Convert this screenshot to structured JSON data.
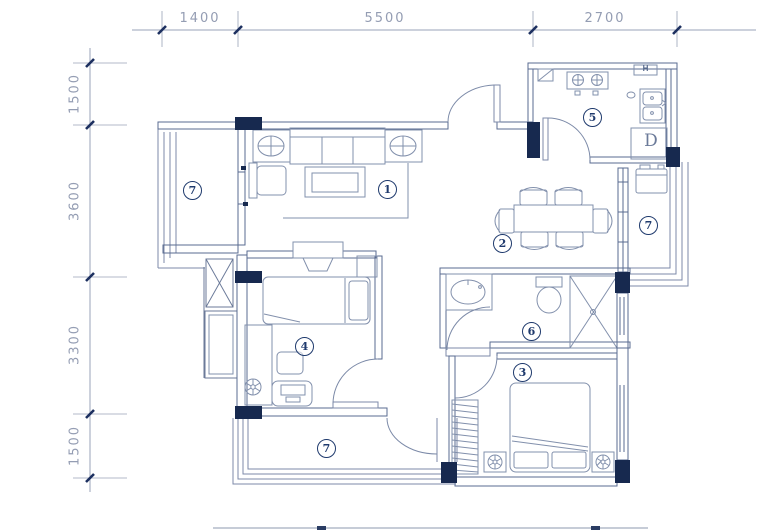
{
  "title": "apartment-floor-plan",
  "colors": {
    "wall_line": "#5a6b90",
    "furniture_line": "#8290ac",
    "column_fill": "#17294f",
    "dimension_text": "#949db3",
    "label_color": "#1f3a6d"
  },
  "dimensions": {
    "top": [
      {
        "text": "1400"
      },
      {
        "text": "5500"
      },
      {
        "text": "2700"
      }
    ],
    "left": [
      {
        "text": "1500"
      },
      {
        "text": "3600"
      },
      {
        "text": "3300"
      },
      {
        "text": "1500"
      }
    ]
  },
  "rooms": [
    {
      "num": "1",
      "name": "living-room"
    },
    {
      "num": "2",
      "name": "dining-room"
    },
    {
      "num": "3",
      "name": "bedroom-secondary"
    },
    {
      "num": "4",
      "name": "bedroom-master"
    },
    {
      "num": "5",
      "name": "kitchen"
    },
    {
      "num": "6",
      "name": "bathroom"
    },
    {
      "num": "7",
      "name": "balcony-left"
    },
    {
      "num": "7",
      "name": "balcony-right"
    },
    {
      "num": "7",
      "name": "balcony-bottom"
    }
  ],
  "labels": {
    "hood": "H",
    "appliance": "D"
  }
}
